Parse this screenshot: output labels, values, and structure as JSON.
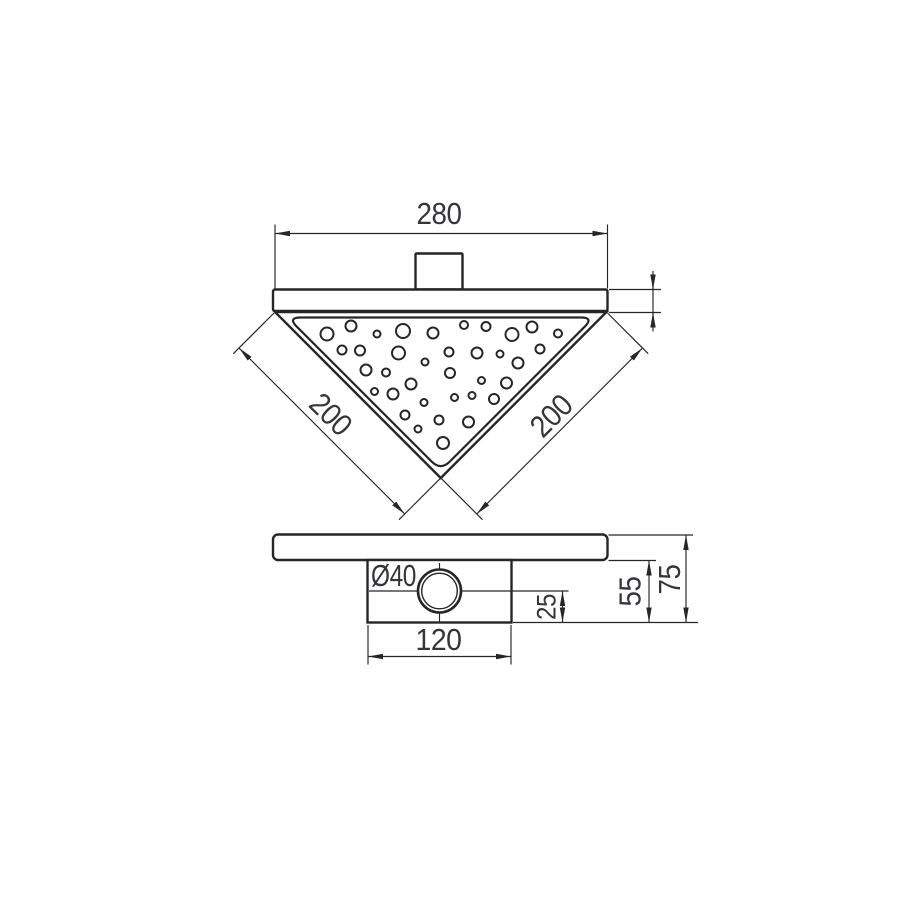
{
  "canvas": {
    "background": "#ffffff",
    "line_color": "#262626",
    "text_color": "#36363a"
  },
  "top_view": {
    "overall_width_label": "280",
    "left_edge_length_label": "200",
    "right_edge_length_label": "200"
  },
  "side_view": {
    "outlet_diameter_label": "Ø40",
    "outlet_axis_to_base_label": "25",
    "body_height_label": "55",
    "overall_height_label": "75",
    "body_width_label": "120"
  },
  "grate_holes": [
    {
      "x": 327,
      "y": 334,
      "r": 6.5
    },
    {
      "x": 351,
      "y": 326,
      "r": 5.5
    },
    {
      "x": 377,
      "y": 334,
      "r": 3.5
    },
    {
      "x": 403,
      "y": 331,
      "r": 7
    },
    {
      "x": 433,
      "y": 333,
      "r": 5.5
    },
    {
      "x": 464,
      "y": 325,
      "r": 4
    },
    {
      "x": 486,
      "y": 326.5,
      "r": 4.5
    },
    {
      "x": 512,
      "y": 334.5,
      "r": 6.5
    },
    {
      "x": 532,
      "y": 327,
      "r": 5.5
    },
    {
      "x": 558,
      "y": 333.5,
      "r": 4
    },
    {
      "x": 342,
      "y": 350,
      "r": 4.5
    },
    {
      "x": 360,
      "y": 350.5,
      "r": 5
    },
    {
      "x": 398.5,
      "y": 353,
      "r": 6.5
    },
    {
      "x": 425,
      "y": 362,
      "r": 3.5
    },
    {
      "x": 449,
      "y": 352,
      "r": 4.5
    },
    {
      "x": 477,
      "y": 353,
      "r": 5.5
    },
    {
      "x": 500,
      "y": 354,
      "r": 3.5
    },
    {
      "x": 518,
      "y": 363,
      "r": 5.5
    },
    {
      "x": 540,
      "y": 349,
      "r": 4.5
    },
    {
      "x": 366,
      "y": 370,
      "r": 5.5
    },
    {
      "x": 386,
      "y": 372.5,
      "r": 4
    },
    {
      "x": 450,
      "y": 373,
      "r": 5
    },
    {
      "x": 481.5,
      "y": 380.5,
      "r": 3.5
    },
    {
      "x": 506.5,
      "y": 383,
      "r": 5.5
    },
    {
      "x": 374.5,
      "y": 391.5,
      "r": 3.5
    },
    {
      "x": 393,
      "y": 394,
      "r": 5.5
    },
    {
      "x": 411,
      "y": 384,
      "r": 5.5
    },
    {
      "x": 424,
      "y": 402.5,
      "r": 3.5
    },
    {
      "x": 454.5,
      "y": 397.5,
      "r": 3.5
    },
    {
      "x": 472,
      "y": 395.5,
      "r": 3.5
    },
    {
      "x": 494,
      "y": 399,
      "r": 5
    },
    {
      "x": 405,
      "y": 415,
      "r": 4.5
    },
    {
      "x": 418,
      "y": 429,
      "r": 3.5
    },
    {
      "x": 439,
      "y": 420,
      "r": 4.5
    },
    {
      "x": 468.5,
      "y": 422,
      "r": 5.5
    },
    {
      "x": 443,
      "y": 443,
      "r": 6
    }
  ]
}
